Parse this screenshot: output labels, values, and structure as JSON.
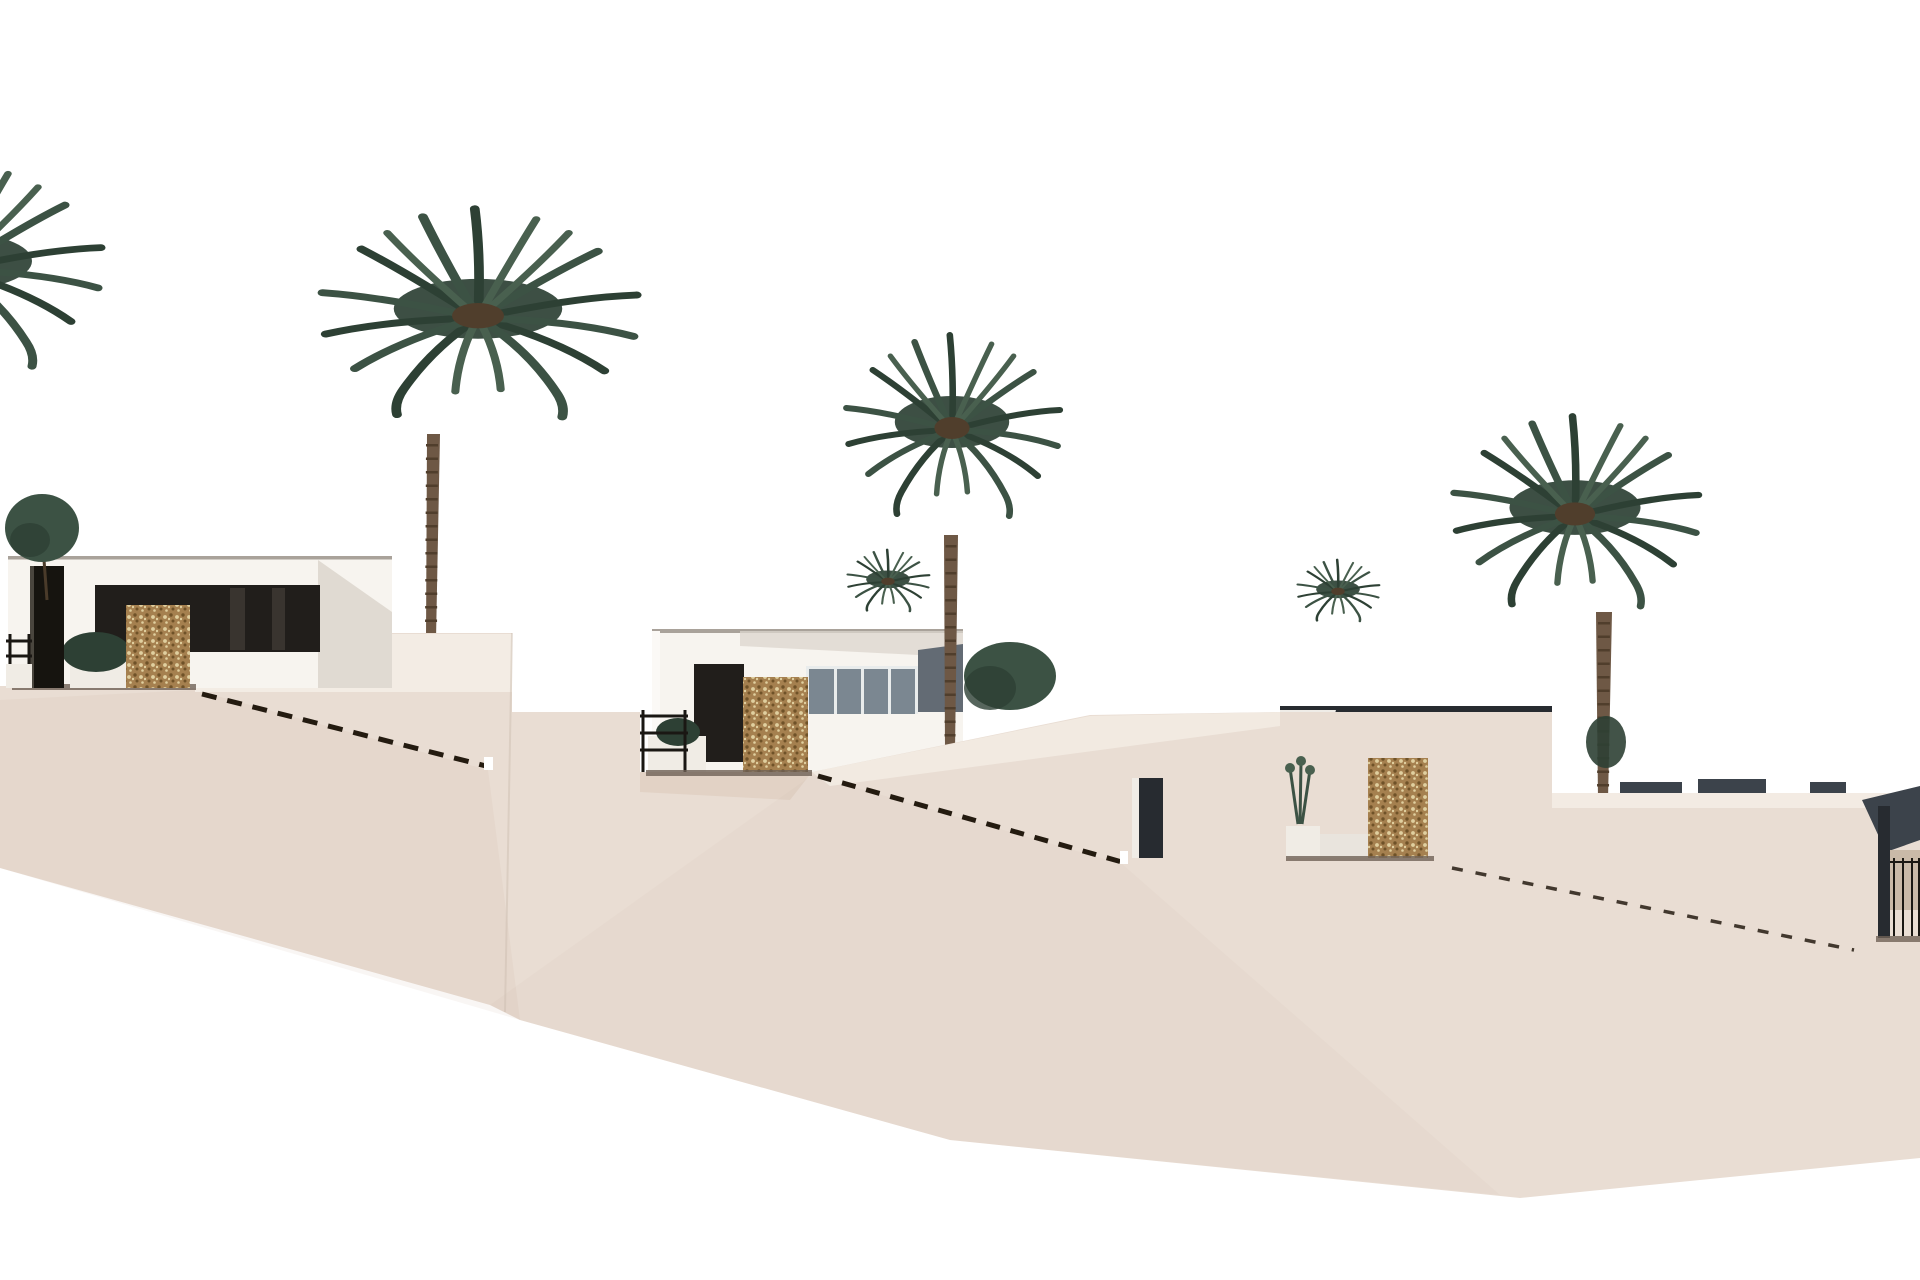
{
  "scene": {
    "type": "architectural-exterior-render",
    "description": "Hillside row of modern white villas on stepped beige terraces descending left to right, with tall palm trees against a white sky",
    "villa_count_visible": 4,
    "palm_count_large": 4
  },
  "colors": {
    "sky": "#ffffff",
    "terrain": "#e9ddd3",
    "terrain_shade": "#c7ab97",
    "wall_light": "#f4ede5",
    "villa_white": "#f7f4ef",
    "villa_base": "#f3efe9",
    "villa_shadow": "#dcd6ce",
    "roof_edge": "#a9a29a",
    "window_dark": "#211e1b",
    "window_glint": "#39342f",
    "glass": "#7b8791",
    "glass_frame": "#e9ecec",
    "slate_wall": "#636b74",
    "slate_dark": "#272b30",
    "slate_open": "#2e3137",
    "distant_roof": "#3c434b",
    "stone_base": "#a5804f",
    "stone_dot_dark": "#6f5228",
    "stone_dot_light": "#e0cf9f",
    "pillar_black": "#16140f",
    "green_dark": "#2d4034",
    "green_mid": "#3c5244",
    "green_light": "#49604f",
    "trunk": "#6e5845",
    "trunk_dark": "#503e2c",
    "rail_black": "#1a1713",
    "floor_shadow": "#6f6256",
    "dash": "#241b10",
    "planter_white": "#f0ece5",
    "interior_tan": "#c9b9a8"
  },
  "objects": {
    "palms": [
      {
        "id": "palm-left-partial",
        "cx": -46,
        "cy": 270
      },
      {
        "id": "palm-a",
        "cx": 478,
        "cy": 318
      },
      {
        "id": "palm-b",
        "cx": 952,
        "cy": 430
      },
      {
        "id": "palm-c",
        "cx": 1575,
        "cy": 516
      }
    ],
    "villas": [
      {
        "id": "villa-1",
        "x": 8,
        "y": 556
      },
      {
        "id": "villa-2",
        "x": 652,
        "y": 629
      },
      {
        "id": "villa-3",
        "x": 1280,
        "y": 706
      },
      {
        "id": "villa-4-partial",
        "x": 1862,
        "y": 786
      }
    ],
    "stair_rails": [
      {
        "id": "stairs-1",
        "x1": 202,
        "y1": 694,
        "x2": 486,
        "y2": 766
      },
      {
        "id": "stairs-2",
        "x1": 818,
        "y1": 776,
        "x2": 1122,
        "y2": 862
      },
      {
        "id": "stairs-3",
        "x1": 1452,
        "y1": 868,
        "x2": 1854,
        "y2": 950
      }
    ]
  }
}
